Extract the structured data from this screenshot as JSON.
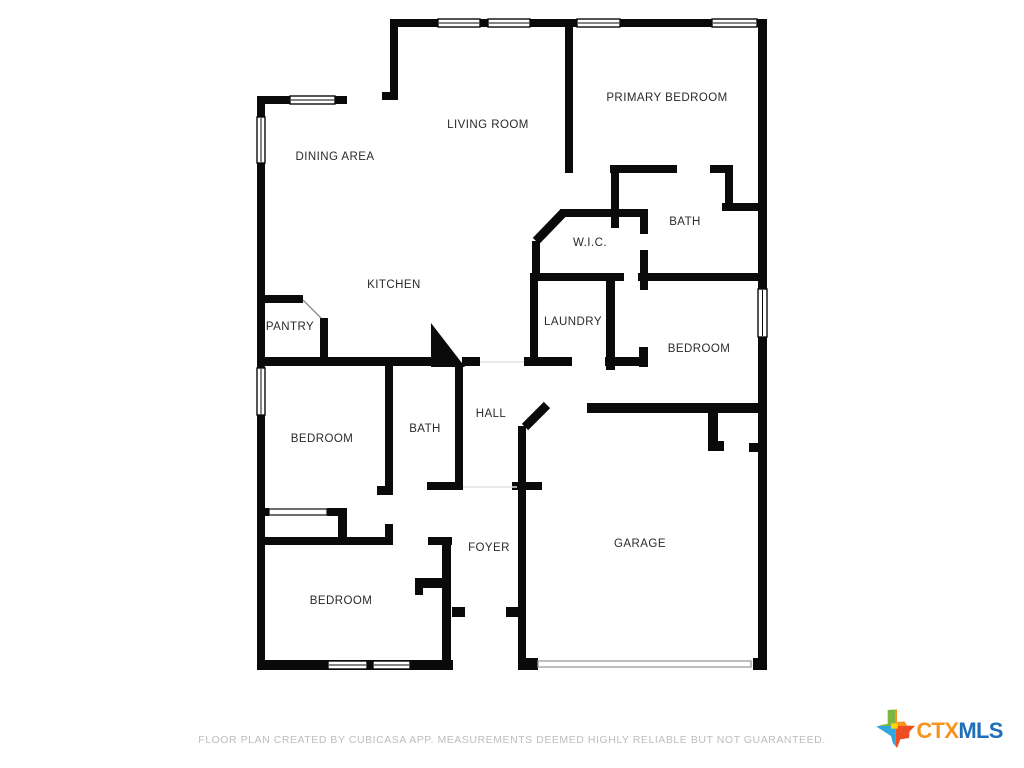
{
  "floorplan": {
    "wall_color": "#0a0a0a",
    "walls": [
      [
        392,
        19,
        374,
        8
      ],
      [
        758,
        19,
        9,
        651
      ],
      [
        390,
        19,
        8,
        81
      ],
      [
        382,
        92,
        16,
        8
      ],
      [
        257,
        96,
        90,
        8
      ],
      [
        257,
        96,
        8,
        574
      ],
      [
        257,
        660,
        196,
        10
      ],
      [
        518,
        658,
        20,
        12
      ],
      [
        753,
        658,
        14,
        12
      ],
      [
        565,
        19,
        8,
        154
      ],
      [
        610,
        165,
        67,
        8
      ],
      [
        710,
        165,
        23,
        8
      ],
      [
        725,
        165,
        8,
        46
      ],
      [
        722,
        203,
        44,
        8
      ],
      [
        611,
        165,
        8,
        63
      ],
      [
        560,
        209,
        85,
        8
      ],
      [
        532,
        241,
        8,
        40
      ],
      [
        532,
        273,
        92,
        8
      ],
      [
        638,
        273,
        128,
        8
      ],
      [
        640,
        209,
        8,
        25
      ],
      [
        640,
        250,
        8,
        40
      ],
      [
        530,
        273,
        8,
        92
      ],
      [
        606,
        281,
        9,
        89
      ],
      [
        524,
        357,
        48,
        9
      ],
      [
        605,
        357,
        42,
        9
      ],
      [
        639,
        347,
        9,
        20
      ],
      [
        587,
        403,
        179,
        10
      ],
      [
        708,
        413,
        10,
        38
      ],
      [
        708,
        441,
        16,
        10
      ],
      [
        749,
        443,
        10,
        9
      ],
      [
        257,
        357,
        175,
        9
      ],
      [
        462,
        357,
        18,
        9
      ],
      [
        263,
        295,
        40,
        8
      ],
      [
        320,
        318,
        8,
        44
      ],
      [
        385,
        363,
        8,
        132
      ],
      [
        377,
        486,
        16,
        9
      ],
      [
        385,
        524,
        8,
        13
      ],
      [
        455,
        363,
        8,
        121
      ],
      [
        427,
        482,
        36,
        8
      ],
      [
        512,
        482,
        30,
        8
      ],
      [
        518,
        426,
        8,
        232
      ],
      [
        452,
        607,
        13,
        10
      ],
      [
        506,
        607,
        13,
        10
      ],
      [
        257,
        508,
        12,
        8
      ],
      [
        327,
        508,
        20,
        8
      ],
      [
        338,
        508,
        9,
        30
      ],
      [
        257,
        537,
        136,
        8
      ],
      [
        428,
        537,
        24,
        8
      ],
      [
        442,
        537,
        9,
        131
      ],
      [
        415,
        578,
        30,
        10
      ],
      [
        415,
        578,
        8,
        17
      ],
      [
        367,
        660,
        6,
        10
      ]
    ],
    "diagonal_walls": [
      [
        536,
        241,
        564,
        212
      ],
      [
        525,
        427,
        547,
        405
      ]
    ],
    "triangle_wall": "431,323 431,367 465,367",
    "windows": [
      [
        438,
        19,
        42,
        8,
        "h"
      ],
      [
        488,
        19,
        42,
        8,
        "h"
      ],
      [
        577,
        19,
        43,
        8,
        "h"
      ],
      [
        712,
        19,
        45,
        8,
        "h"
      ],
      [
        290,
        96,
        45,
        8,
        "h"
      ],
      [
        257,
        117,
        8,
        46,
        "v"
      ],
      [
        257,
        368,
        8,
        47,
        "v"
      ],
      [
        758,
        289,
        9,
        48,
        "v"
      ],
      [
        328,
        661,
        39,
        8,
        "h"
      ],
      [
        373,
        661,
        37,
        8,
        "h"
      ]
    ],
    "garage_door": [
      538,
      661,
      213,
      6
    ],
    "sliding_door": [
      269,
      509,
      58,
      6
    ],
    "door_leaves": [
      [
        303,
        300,
        321,
        318
      ]
    ],
    "open_boundaries": [
      [
        463,
        487,
        517,
        487
      ],
      [
        480,
        362,
        524,
        362
      ]
    ],
    "rooms": [
      {
        "name": "LIVING ROOM",
        "slug": "living-room",
        "x": 488,
        "y": 125
      },
      {
        "name": "PRIMARY BEDROOM",
        "slug": "primary-bedroom",
        "x": 667,
        "y": 98
      },
      {
        "name": "DINING AREA",
        "slug": "dining-area",
        "x": 335,
        "y": 157
      },
      {
        "name": "BATH",
        "slug": "bath-primary",
        "x": 685,
        "y": 222
      },
      {
        "name": "W.I.C.",
        "slug": "wic",
        "x": 590,
        "y": 243
      },
      {
        "name": "KITCHEN",
        "slug": "kitchen",
        "x": 394,
        "y": 285
      },
      {
        "name": "PANTRY",
        "slug": "pantry",
        "x": 290,
        "y": 327
      },
      {
        "name": "LAUNDRY",
        "slug": "laundry",
        "x": 573,
        "y": 322
      },
      {
        "name": "BEDROOM",
        "slug": "bedroom-right",
        "x": 699,
        "y": 349
      },
      {
        "name": "BATH",
        "slug": "bath-hall",
        "x": 425,
        "y": 429
      },
      {
        "name": "HALL",
        "slug": "hall",
        "x": 491,
        "y": 414
      },
      {
        "name": "BEDROOM",
        "slug": "bedroom-left",
        "x": 322,
        "y": 439
      },
      {
        "name": "FOYER",
        "slug": "foyer",
        "x": 489,
        "y": 548
      },
      {
        "name": "GARAGE",
        "slug": "garage",
        "x": 640,
        "y": 544
      },
      {
        "name": "BEDROOM",
        "slug": "bedroom-bottom",
        "x": 341,
        "y": 601
      }
    ]
  },
  "footer": {
    "disclaimer": "FLOOR PLAN CREATED BY CUBICASA APP. MEASUREMENTS DEEMED HIGHLY RELIABLE BUT NOT GUARANTEED."
  },
  "logo": {
    "ctx": "CTX",
    "mls": "MLS",
    "colors": {
      "ctx_text": "#F7941E",
      "mls_text": "#1F6FB8",
      "tx_green": "#7CB542",
      "tx_orange": "#F7941E",
      "tx_blue": "#2FA8DF",
      "tx_red": "#EF4E23",
      "tx_yellow": "#FFD400"
    }
  }
}
